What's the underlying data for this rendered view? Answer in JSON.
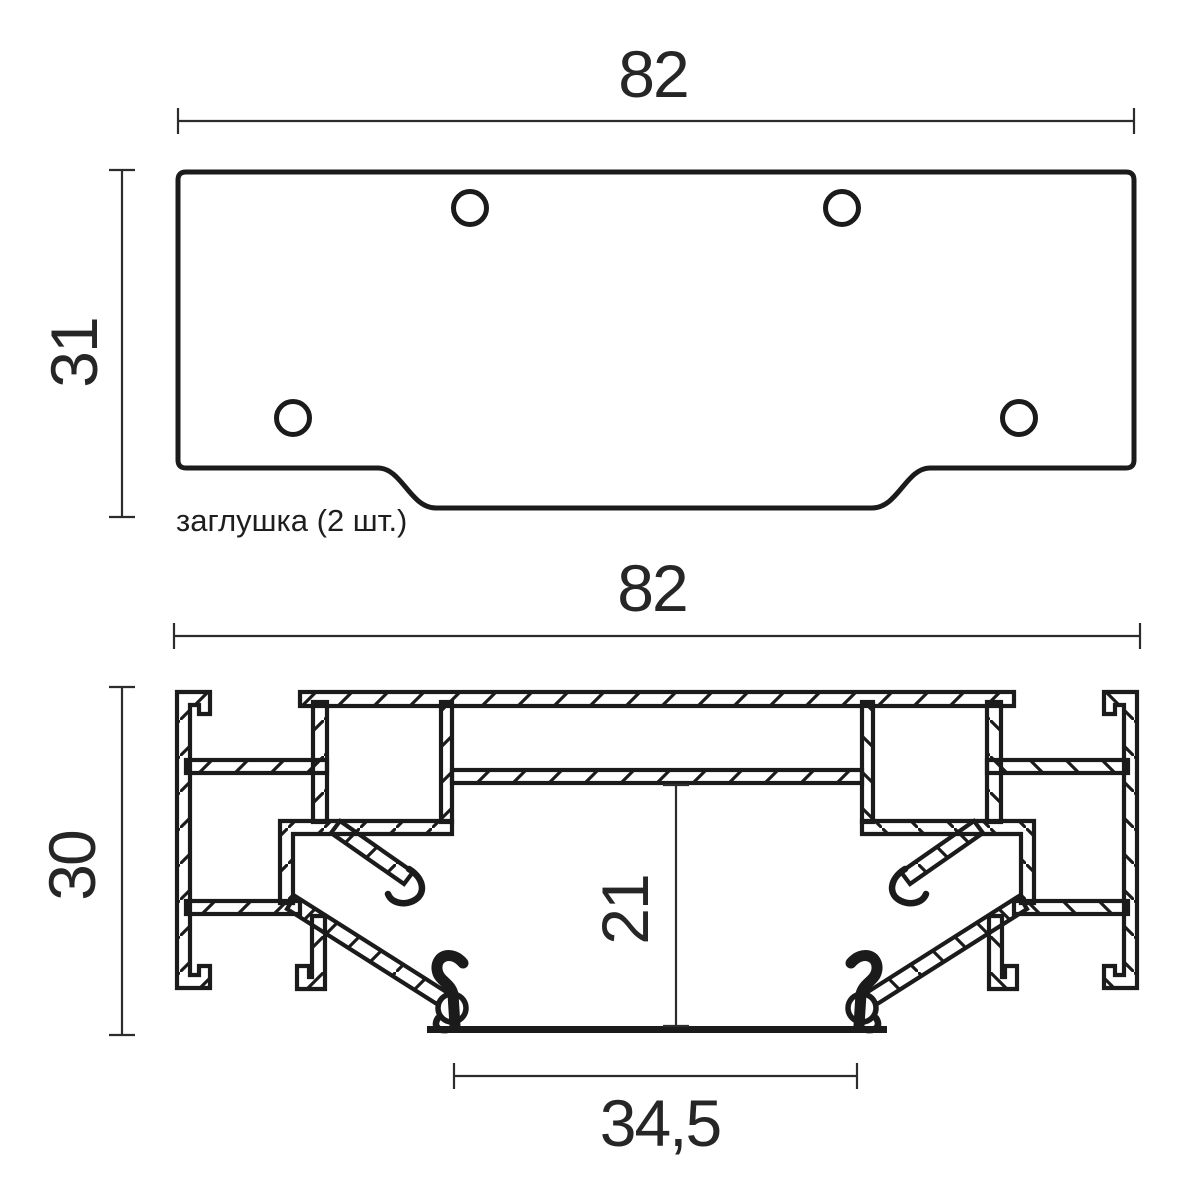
{
  "drawing": {
    "background": "#ffffff",
    "line_color": "#1b1b1b",
    "dim_color": "#2c2c2c",
    "top_view": {
      "description": "end cap plate, top view",
      "width_label": "82",
      "height_label": "31",
      "caption": "заглушка (2 шт.)",
      "hole_count": 4
    },
    "section": {
      "description": "aluminum profile cross-section",
      "width_label": "82",
      "height_label": "30",
      "inner_height_label": "21",
      "bottom_width_label": "34,5"
    }
  }
}
